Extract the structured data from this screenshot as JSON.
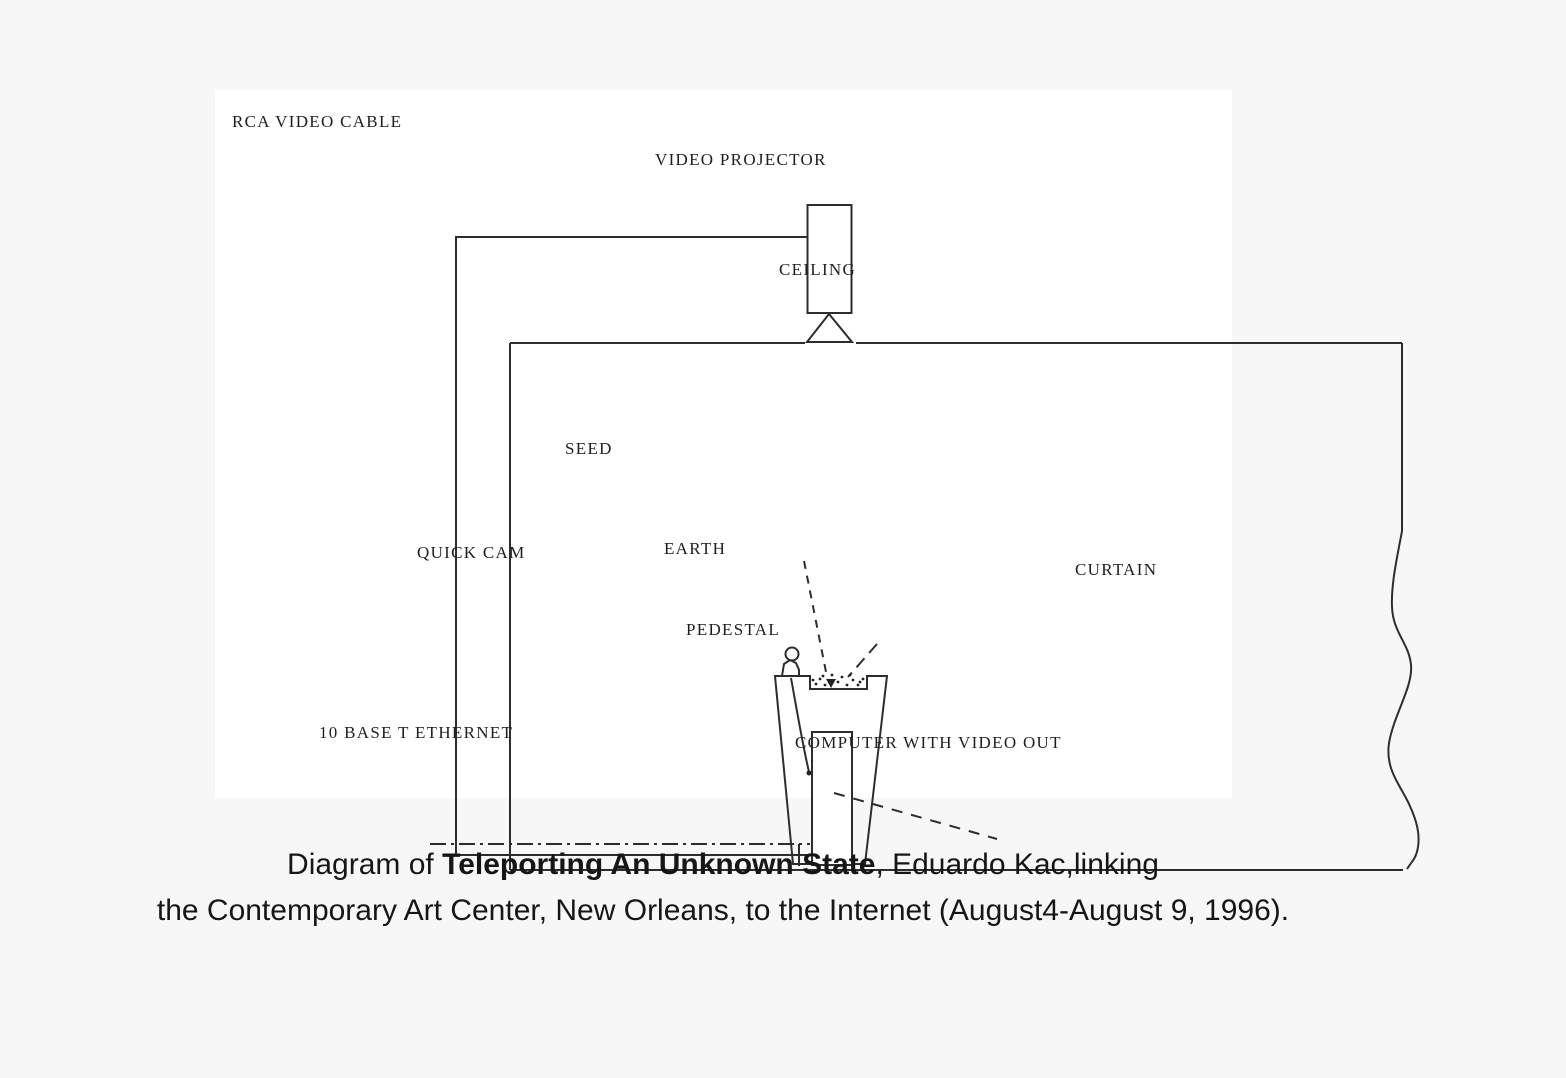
{
  "page": {
    "background_color": "#f7f7f8",
    "diagram_background_color": "#ffffff",
    "line_color": "#2d2d2d",
    "label_color": "#1f1f1f"
  },
  "diagram": {
    "labels": {
      "rca_video_cable": "RCA VIDEO CABLE",
      "video_projector": "VIDEO PROJECTOR",
      "ceiling": "CEILING",
      "seed": "SEED",
      "quick_cam": "QUICK CAM",
      "earth": "EARTH",
      "pedestal": "PEDESTAL",
      "curtain": "CURTAIN",
      "ethernet_10baset": "10 BASE T ETHERNET",
      "computer_video_out": "COMPUTER WITH VIDEO OUT"
    }
  },
  "caption": {
    "line1_prefix": "Diagram of ",
    "artwork_title": "Teleporting An Unknown State",
    "line1_suffix": ", Eduardo Kac,linking",
    "line2": "the Contemporary Art Center, New Orleans, to the Internet (August4-August 9, 1996)."
  }
}
